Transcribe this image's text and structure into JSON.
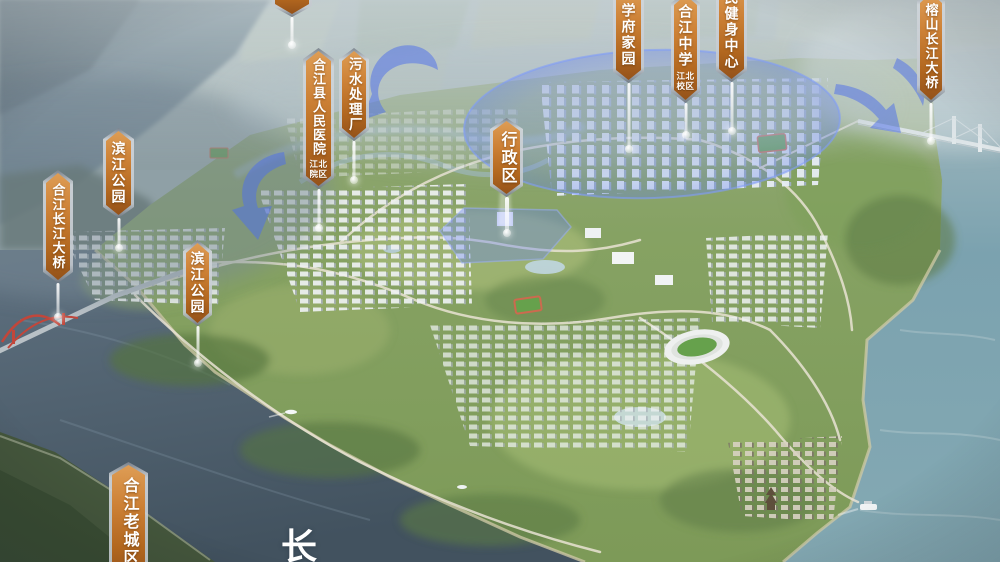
{
  "scene": {
    "description_visible_text_only": true,
    "river_name_text": "长"
  },
  "markers": [
    {
      "id": "sha",
      "label": "沙"
    },
    {
      "id": "binjiang-park-north",
      "label": "滨江公园"
    },
    {
      "id": "hejiang-yangtze-bridge",
      "label": "合江长江大桥"
    },
    {
      "id": "binjiang-park-south",
      "label": "滨江公园"
    },
    {
      "id": "hejiang-county-hospital",
      "label": "合江县人民医院",
      "sublabel": "江北院区"
    },
    {
      "id": "sewage-treatment-plant",
      "label": "污水处理厂"
    },
    {
      "id": "administrative-district",
      "label": "行政区"
    },
    {
      "id": "xuefu-jiayuan",
      "label": "学府家园"
    },
    {
      "id": "hejiang-middle-school",
      "label": "合江中学",
      "sublabel": "江北校区"
    },
    {
      "id": "citizens-fitness-center",
      "label": "民健身中心"
    },
    {
      "id": "rongshan-yangtze-bridge",
      "label": "榕山长江大桥"
    },
    {
      "id": "hejiang-old-town",
      "label": "合江老城区"
    }
  ],
  "colors": {
    "marker_orange_top": "#de9d55",
    "marker_orange_bottom": "#94521a",
    "marker_frame_silver": "#c4c9cf",
    "highlight_blue": "#5a78e6",
    "water_left": "#4c5d6b",
    "water_right": "#7ba2af",
    "land_green": "#83a05e",
    "red_bridge": "#c2463a"
  }
}
